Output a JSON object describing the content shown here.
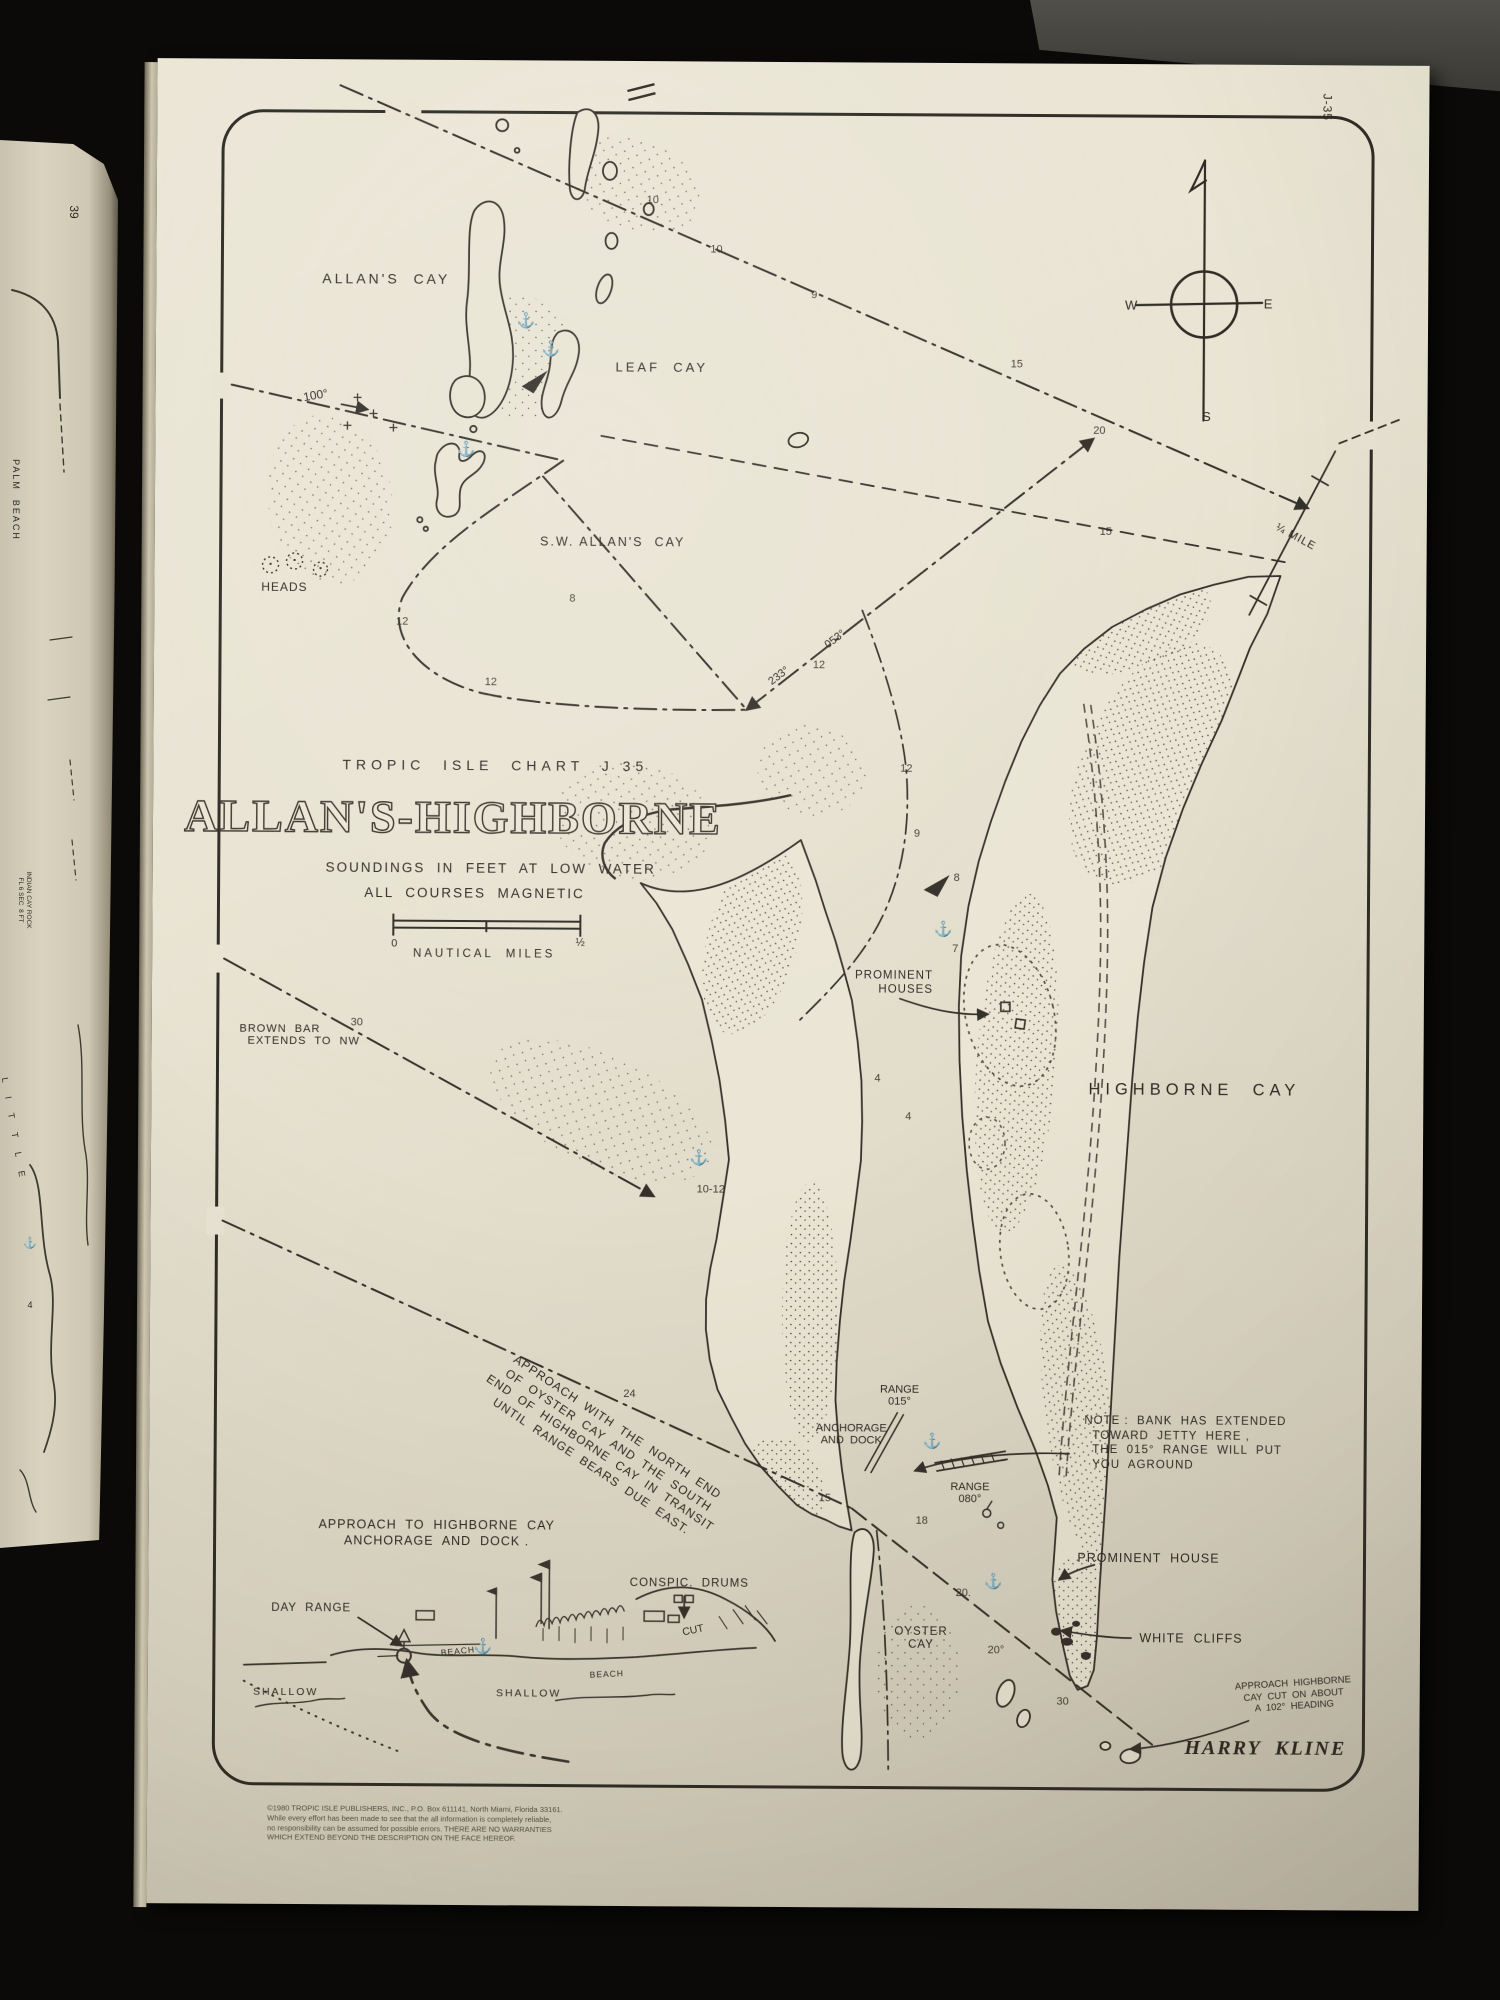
{
  "colors": {
    "paper": "#e9e4d3",
    "ink": "#34302a",
    "background": "#0b0a09",
    "left_paper": "#d6cfba",
    "gray_object": "#47463f"
  },
  "page": {
    "chart_code": "J-35",
    "kicker": "TROPIC  ISLE  CHART  J 35",
    "title": "ALLAN'S-HIGHBORNE",
    "subtitle1": "SOUNDINGS  IN  FEET  AT  LOW  WATER",
    "subtitle2": "ALL  COURSES  MAGNETIC",
    "scale_caption": "NAUTICAL  MILES",
    "credit": "HARRY  KLINE"
  },
  "compass": {
    "w": "W",
    "e": "E",
    "s": "S"
  },
  "labels": [
    {
      "id": "chart-kicker",
      "t": "TROPIC  ISLE  CHART  J 35",
      "x": 342,
      "y": 705,
      "fs": 14,
      "ls": 5
    },
    {
      "id": "chart-title",
      "t": "ALLAN'S-HIGHBORNE",
      "x": 300,
      "y": 757,
      "fs": 46,
      "ls": 2,
      "cls": "title"
    },
    {
      "id": "subtitle-soundings",
      "t": "SOUNDINGS  IN  FEET  AT  LOW  WATER",
      "x": 338,
      "y": 808,
      "fs": 13.5,
      "ls": 2
    },
    {
      "id": "subtitle-courses",
      "t": "ALL  COURSES  MAGNETIC",
      "x": 322,
      "y": 833,
      "fs": 13.5,
      "ls": 2
    },
    {
      "id": "scale-zero",
      "t": "0",
      "x": 242,
      "y": 884,
      "fs": 11
    },
    {
      "id": "scale-half",
      "t": "½",
      "x": 428,
      "y": 882,
      "fs": 11
    },
    {
      "id": "scale-caption",
      "t": "NAUTICAL  MILES",
      "x": 332,
      "y": 894,
      "fs": 11.5,
      "ls": 3
    },
    {
      "id": "allans-cay",
      "t": "ALLAN'S  CAY",
      "x": 230,
      "y": 219,
      "fs": 14,
      "ls": 3
    },
    {
      "id": "leaf-cay",
      "t": "LEAF  CAY",
      "x": 506,
      "y": 306,
      "fs": 13,
      "ls": 3
    },
    {
      "id": "sw-allans-cay",
      "t": "S.W. ALLAN'S  CAY",
      "x": 458,
      "y": 481,
      "fs": 12.5,
      "ls": 2
    },
    {
      "id": "heads",
      "t": "HEADS",
      "x": 130,
      "y": 528,
      "fs": 12,
      "ls": 1
    },
    {
      "id": "course-100",
      "t": "100°",
      "x": 160,
      "y": 336,
      "fs": 12,
      "rot": -10
    },
    {
      "id": "course-233",
      "t": "233°",
      "x": 625,
      "y": 614,
      "fs": 11,
      "rot": -38
    },
    {
      "id": "course-053",
      "t": "053°",
      "x": 681,
      "y": 577,
      "fs": 11,
      "rot": -38
    },
    {
      "id": "quarter-mile",
      "t": "¼ MILE",
      "x": 1141,
      "y": 472,
      "fs": 11,
      "rot": 28,
      "ls": 1
    },
    {
      "id": "corner-code",
      "t": "J-35",
      "x": 1170,
      "y": 42,
      "fs": 12,
      "rot": 90,
      "ls": 1
    },
    {
      "id": "compass-w",
      "t": "W",
      "x": 975,
      "y": 241,
      "fs": 13
    },
    {
      "id": "compass-e",
      "t": "E",
      "x": 1112,
      "y": 239,
      "fs": 13
    },
    {
      "id": "compass-s",
      "t": "S",
      "x": 1051,
      "y": 352,
      "fs": 13
    },
    {
      "id": "brown-bar",
      "t": "BROWN  BAR\n  EXTENDS  TO  NW",
      "x": 148,
      "y": 976,
      "fs": 11,
      "lh": 12,
      "al": "left",
      "ls": 1
    },
    {
      "id": "prominent-houses",
      "t": "PROMINENT\nHOUSES",
      "x": 742,
      "y": 920,
      "fs": 11.5,
      "lh": 14,
      "al": "right",
      "ls": 1
    },
    {
      "id": "highborne-cay",
      "t": "HIGHBORNE  CAY",
      "x": 1043,
      "y": 1026,
      "fs": 16.5,
      "ls": 5
    },
    {
      "id": "note-bank",
      "t": "NOTE :  BANK  HAS  EXTENDED\n  TOWARD  JETTY  HERE ,\n  THE  015°  RANGE  WILL  PUT\n  YOU  AGROUND",
      "x": 1036,
      "y": 1379,
      "fs": 11.5,
      "lh": 14.5,
      "al": "left",
      "ls": 1
    },
    {
      "id": "range-015",
      "t": "RANGE\n015°",
      "x": 750,
      "y": 1333,
      "fs": 11,
      "lh": 12
    },
    {
      "id": "anchorage-and-dock",
      "t": "ANCHORAGE\nAND  DOCK",
      "x": 702,
      "y": 1372,
      "fs": 11,
      "lh": 12
    },
    {
      "id": "range-080",
      "t": "RANGE\n080°",
      "x": 821,
      "y": 1430,
      "fs": 11,
      "lh": 12
    },
    {
      "id": "approach-transit",
      "t": "APPROACH  WITH  THE  NORTH  END\nOF  OYSTER  CAY  AND  THE  SOUTH\nEND  OF  HIGHBORNE  CAY  IN  TRANSIT\nUNTIL  RANGE  BEARS  DUE  EAST.",
      "x": 455,
      "y": 1386,
      "fs": 12,
      "lh": 15.5,
      "rot": 33.5,
      "ls": 1
    },
    {
      "id": "approach-anchorage",
      "t": "APPROACH  TO  HIGHBORNE  CAY\nANCHORAGE  AND  DOCK .",
      "x": 288,
      "y": 1473,
      "fs": 12.5,
      "lh": 16,
      "ls": 1
    },
    {
      "id": "conspic-drums",
      "t": "CONSPIC.  DRUMS",
      "x": 541,
      "y": 1522,
      "fs": 11.5,
      "ls": 1
    },
    {
      "id": "day-range",
      "t": "DAY  RANGE",
      "x": 163,
      "y": 1549,
      "fs": 11.5,
      "ls": 1
    },
    {
      "id": "cut",
      "t": "CUT",
      "x": 545,
      "y": 1569,
      "fs": 10.5,
      "rot": -12
    },
    {
      "id": "beach-1",
      "t": "BEACH",
      "x": 310,
      "y": 1591,
      "fs": 8.5,
      "rot": -6,
      "ls": 1
    },
    {
      "id": "beach-2",
      "t": "BEACH",
      "x": 459,
      "y": 1613,
      "fs": 8.5,
      "rot": -3,
      "ls": 1
    },
    {
      "id": "shallow-1",
      "t": "SHALLOW",
      "x": 138,
      "y": 1633,
      "fs": 10.5,
      "ls": 2
    },
    {
      "id": "shallow-2",
      "t": "SHALLOW",
      "x": 381,
      "y": 1633,
      "fs": 10.5,
      "ls": 2
    },
    {
      "id": "oyster-cay",
      "t": "OYSTER\nCAY",
      "x": 773,
      "y": 1576,
      "fs": 11.5,
      "lh": 13,
      "ls": 1
    },
    {
      "id": "prominent-house",
      "t": "PROMINENT  HOUSE",
      "x": 1000,
      "y": 1494,
      "fs": 12.5,
      "ls": 1
    },
    {
      "id": "white-cliffs",
      "t": "WHITE  CLIFFS",
      "x": 1043,
      "y": 1574,
      "fs": 12.5,
      "ls": 1
    },
    {
      "id": "approach-cut-note",
      "t": "APPROACH  HIGHBORNE\nCAY  CUT  ON  ABOUT\nA  102°  HEADING",
      "x": 1146,
      "y": 1630,
      "fs": 9.5,
      "lh": 11.5,
      "rot": -4
    },
    {
      "id": "signature",
      "t": "HARRY  KLINE",
      "x": 1118,
      "y": 1684,
      "fs": 20,
      "ls": 2,
      "cls": "sig"
    },
    {
      "id": "fine-print",
      "t": "©1980 TROPIC ISLE PUBLISHERS, INC., P.O. Box 611141, North Miami, Florida 33161.\nWhile every effort has been made to see that the all information is completely reliable,\nno responsibility can be assumed for possible errors. THERE ARE NO WARRANTIES\nWHICH EXTEND BEYOND THE DESCRIPTION ON THE FACE HEREOF.",
      "x": 268,
      "y": 1764,
      "fs": 7.5,
      "lh": 9.8,
      "al": "left",
      "cls": "fine"
    }
  ],
  "depths": [
    {
      "t": "10",
      "x": 496,
      "y": 139
    },
    {
      "t": "10",
      "x": 560,
      "y": 188
    },
    {
      "t": "9",
      "x": 658,
      "y": 233
    },
    {
      "t": "15",
      "x": 861,
      "y": 301
    },
    {
      "t": "20",
      "x": 944,
      "y": 367
    },
    {
      "t": "15",
      "x": 951,
      "y": 468
    },
    {
      "t": "12",
      "x": 248,
      "y": 562
    },
    {
      "t": "12",
      "x": 337,
      "y": 622
    },
    {
      "t": "8",
      "x": 418,
      "y": 538
    },
    {
      "t": "12",
      "x": 665,
      "y": 603
    },
    {
      "t": "12",
      "x": 753,
      "y": 706
    },
    {
      "t": "9",
      "x": 764,
      "y": 771
    },
    {
      "t": "8",
      "x": 804,
      "y": 815
    },
    {
      "t": "7",
      "x": 803,
      "y": 886
    },
    {
      "t": "4",
      "x": 726,
      "y": 1016
    },
    {
      "t": "4",
      "x": 757,
      "y": 1054
    },
    {
      "t": "30",
      "x": 205,
      "y": 963
    },
    {
      "t": "24",
      "x": 480,
      "y": 1333
    },
    {
      "t": "10-12",
      "x": 560,
      "y": 1128
    },
    {
      "t": "15",
      "x": 676,
      "y": 1436
    },
    {
      "t": "18",
      "x": 773,
      "y": 1458
    },
    {
      "t": "20.",
      "x": 815,
      "y": 1530
    },
    {
      "t": "20°",
      "x": 848,
      "y": 1587
    },
    {
      "t": "30",
      "x": 915,
      "y": 1638
    }
  ],
  "anchors": {
    "glyph": "⚓",
    "points": [
      {
        "x": 370,
        "y": 260
      },
      {
        "x": 395,
        "y": 288
      },
      {
        "x": 311,
        "y": 389
      },
      {
        "x": 548,
        "y": 1096
      },
      {
        "x": 791,
        "y": 866
      },
      {
        "x": 783,
        "y": 1378
      },
      {
        "x": 845,
        "y": 1518
      },
      {
        "x": 335,
        "y": 1586
      }
    ]
  },
  "left_page": {
    "labels": [
      {
        "id": "neighbor-page-number",
        "t": "39",
        "x": 74,
        "y": 212,
        "fs": 12,
        "rot": 90
      },
      {
        "id": "neighbor-palm-beach",
        "t": "PALM  BEACH",
        "x": 16,
        "y": 500,
        "fs": 9,
        "rot": 90,
        "ls": 2
      },
      {
        "id": "neighbor-indian-cay",
        "t": "INDIAN CAY ROCK\nFL 6 SEC  8 FT",
        "x": 24,
        "y": 900,
        "fs": 6.5,
        "rot": 90,
        "lh": 8
      },
      {
        "id": "neighbor-little",
        "t": "L I T T L E",
        "x": 14,
        "y": 1130,
        "fs": 9,
        "rot": 80,
        "ls": 6
      },
      {
        "id": "neighbor-anchor",
        "t": "⚓",
        "x": 30,
        "y": 1243,
        "fs": 11
      },
      {
        "id": "neighbor-depth",
        "t": "4",
        "x": 30,
        "y": 1305,
        "fs": 9
      }
    ]
  }
}
